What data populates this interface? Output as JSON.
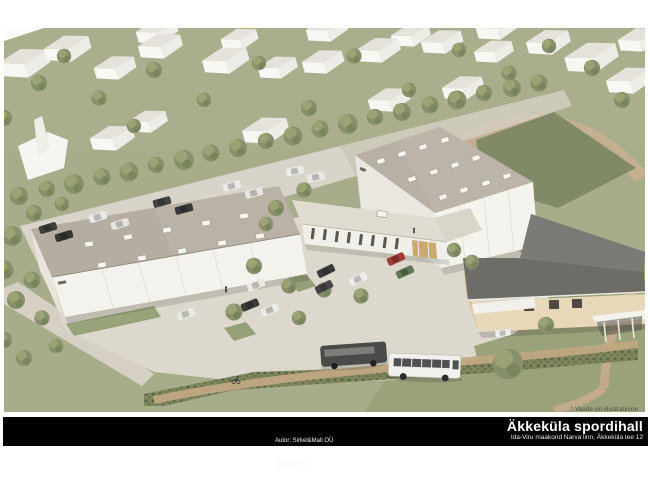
{
  "sheet": {
    "note": "* Vaade on illustratiivne",
    "title_block": {
      "author_line": "Autor: Sirkel&Mall OÜ",
      "sheet_line": "Leht: Leht 1",
      "project_title": "Äkkeküla spordihall",
      "project_address": "Ida-Viru maakond Narva linn, Äkkeküla tee 12"
    },
    "scene_palette": {
      "banner_bg": "#000000",
      "banner_text": "#ffffff",
      "grass": "#a7ad8a",
      "pavement": "#dcd7cc",
      "hall_roof": "#b6aea2",
      "existing_roof": "#75746f",
      "white_walls": "#f4f2ed",
      "tan_walls": "#e6d8b8",
      "track_tan": "#c6b092",
      "tree_green": "#87906a"
    }
  }
}
